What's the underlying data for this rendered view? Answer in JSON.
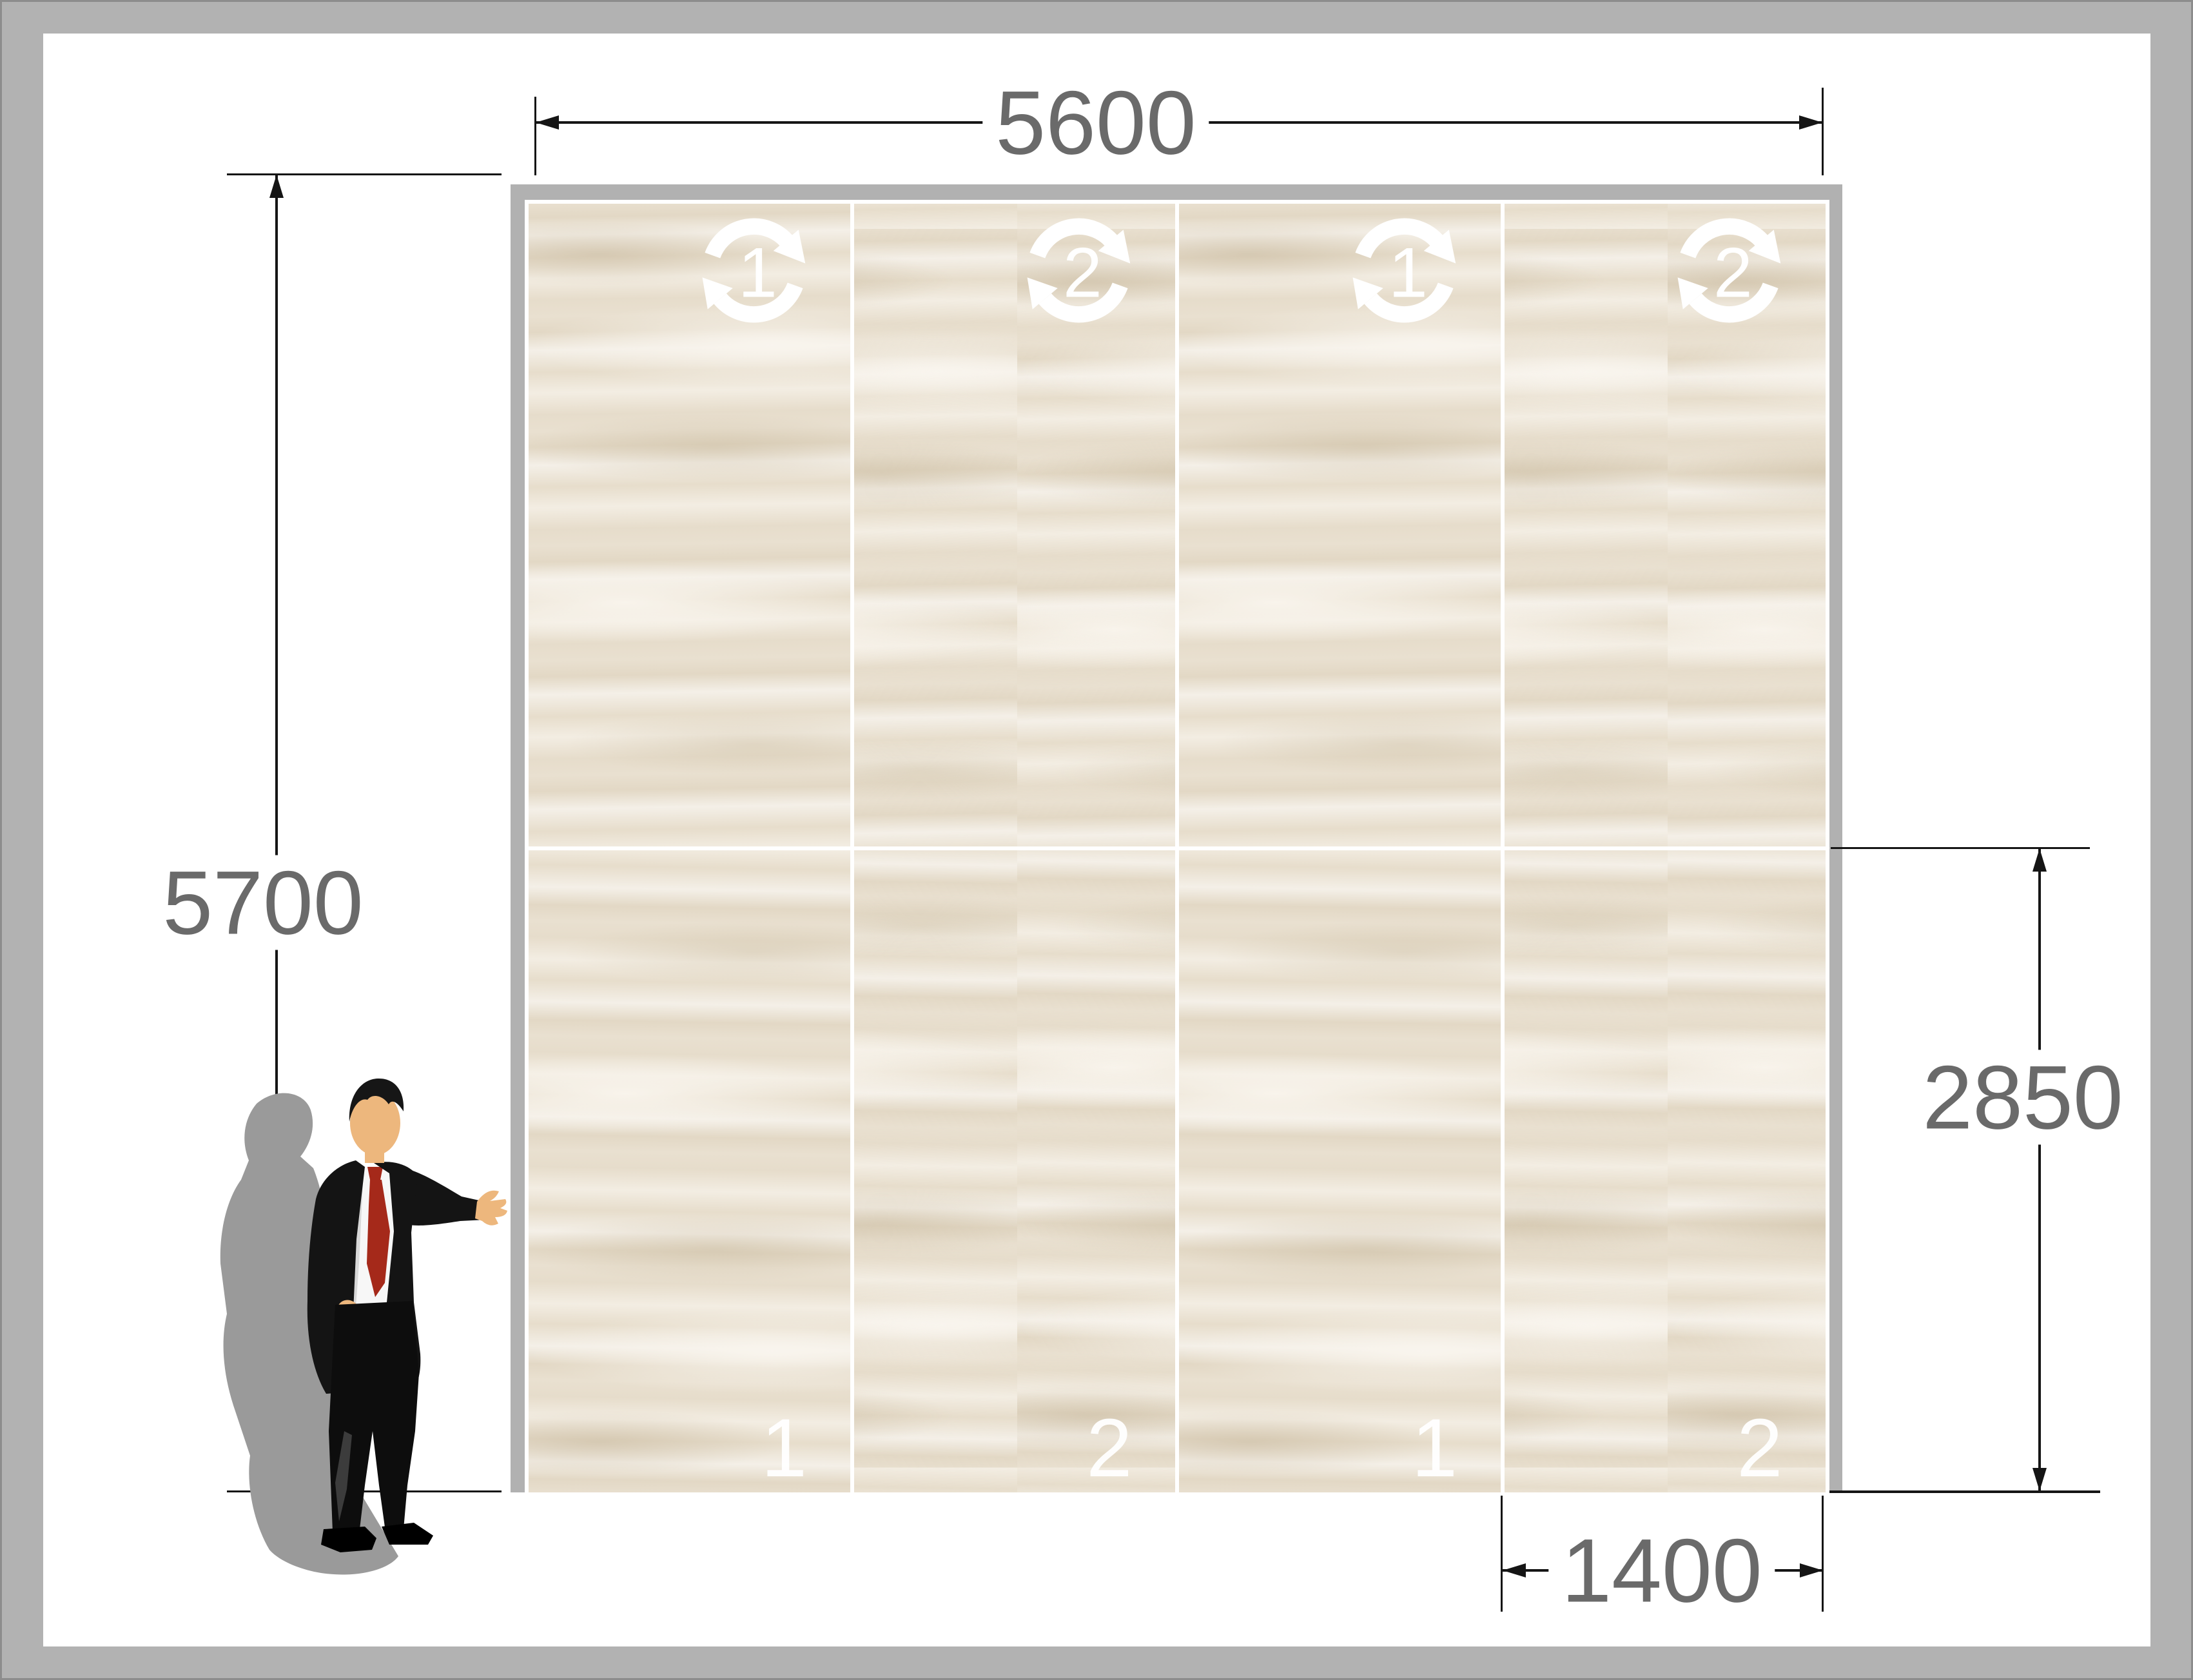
{
  "title": "Wall panel layout drawing",
  "dimensions": {
    "width": {
      "value": "5600"
    },
    "height": {
      "value": "5700"
    },
    "half_height": {
      "value": "2850"
    },
    "panel_width": {
      "value": "1400"
    }
  },
  "wall": {
    "panels": [
      {
        "icon": "rotation-icon",
        "icon_label": "1",
        "bottom_label": "1",
        "pattern": "1"
      },
      {
        "icon": "rotation-icon",
        "icon_label": "2",
        "bottom_label": "2",
        "pattern": "2"
      },
      {
        "icon": "rotation-icon",
        "icon_label": "1",
        "bottom_label": "1",
        "pattern": "1"
      },
      {
        "icon": "rotation-icon",
        "icon_label": "2",
        "bottom_label": "2",
        "pattern": "2"
      }
    ]
  },
  "figure": {
    "type": "businessman-presenting-illustration"
  },
  "colors": {
    "page_border": "#b2b2b2",
    "wall_frame": "#b1b1b1",
    "tile_base": "#e9e0d0",
    "grout": "#ffffff",
    "dimension_text": "#6a6a6a",
    "dimension_line": "#151515",
    "icon": "#ffffff",
    "tie_red": "#a5291a",
    "suit_black": "#141414",
    "skin": "#edb77d",
    "shadow_gray": "#9a9a9a"
  }
}
